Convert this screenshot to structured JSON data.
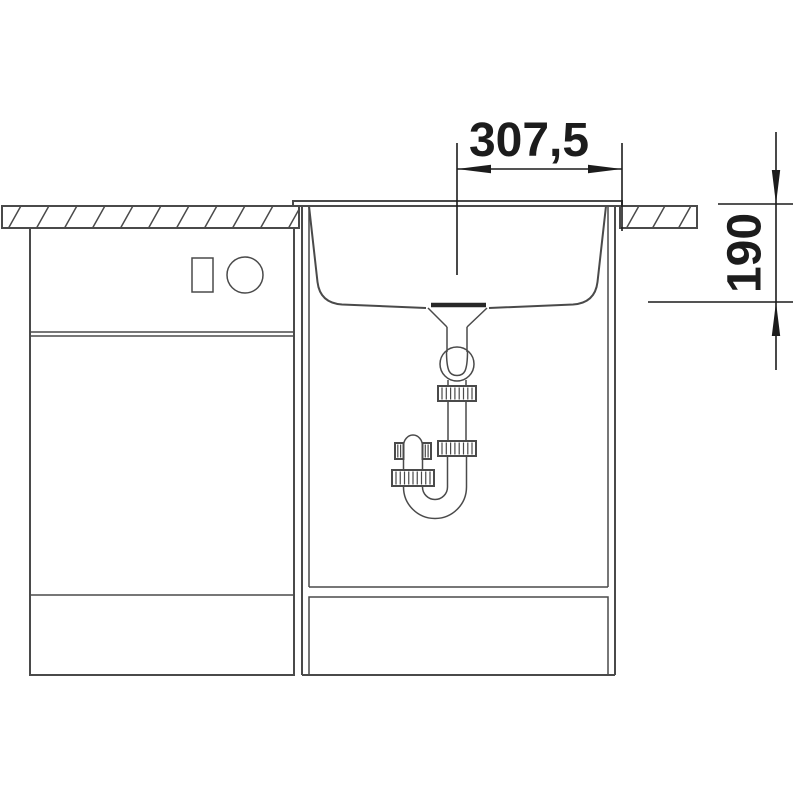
{
  "drawing": {
    "dimension_labels": {
      "basin_width": "307,5",
      "basin_depth": "190"
    },
    "colors": {
      "background": "#ffffff",
      "line": "#4a4a4a",
      "dim": "#1c1c1c"
    }
  }
}
